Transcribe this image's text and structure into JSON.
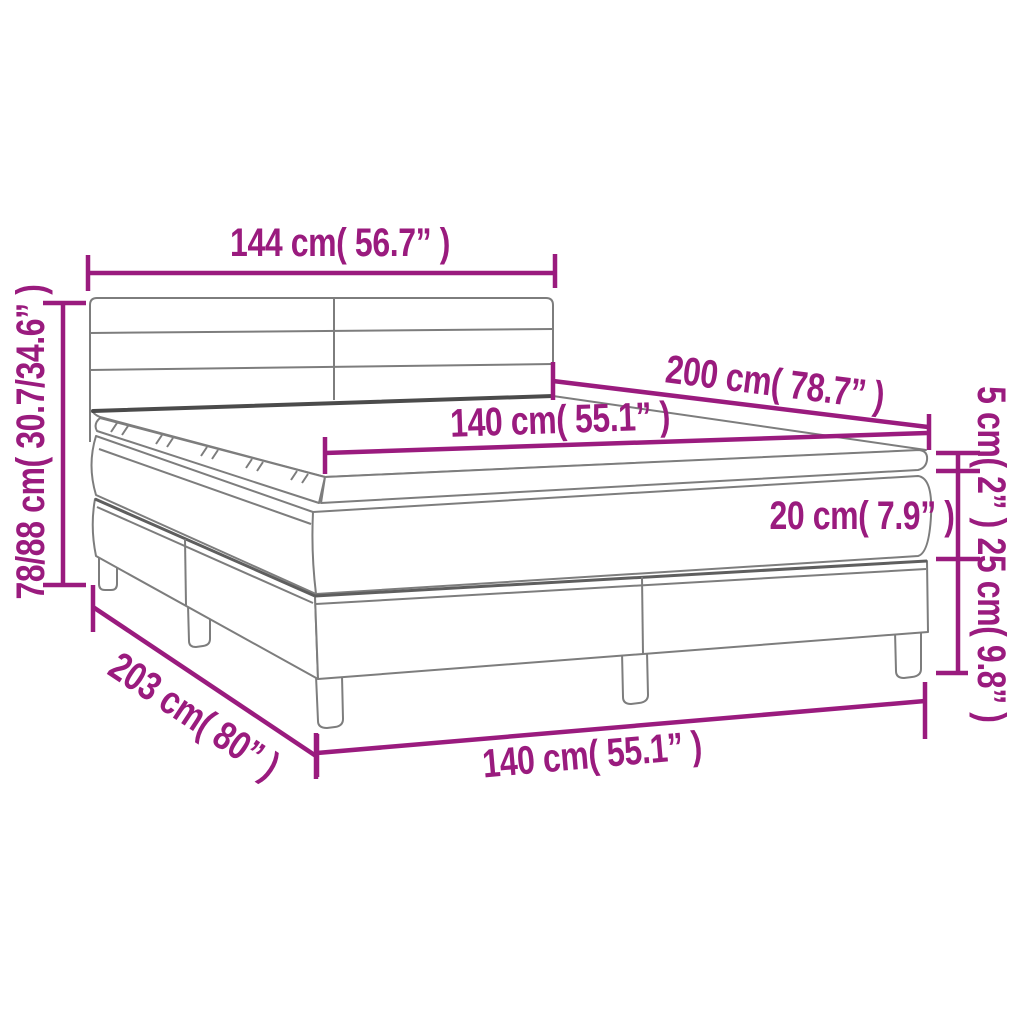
{
  "colors": {
    "accent": "#9A1B7E",
    "drawing_line": "#7d7d7d",
    "drawing_line_dark": "#4b4b4b",
    "background": "#ffffff"
  },
  "dimensions": {
    "headboard_width": "144 cm( 56.7” )",
    "bed_length": "200 cm( 78.7” )",
    "mattress_width_top": "140 cm( 55.1” )",
    "topper_height": "5 cm( 2” )",
    "mattress_height": "20 cm( 7.9” )",
    "base_height": "25 cm( 9.8” )",
    "total_height": "78/88 cm( 30.7/34.6” )",
    "base_length": "203 cm( 80” )",
    "base_width": "140 cm( 55.1” )"
  }
}
